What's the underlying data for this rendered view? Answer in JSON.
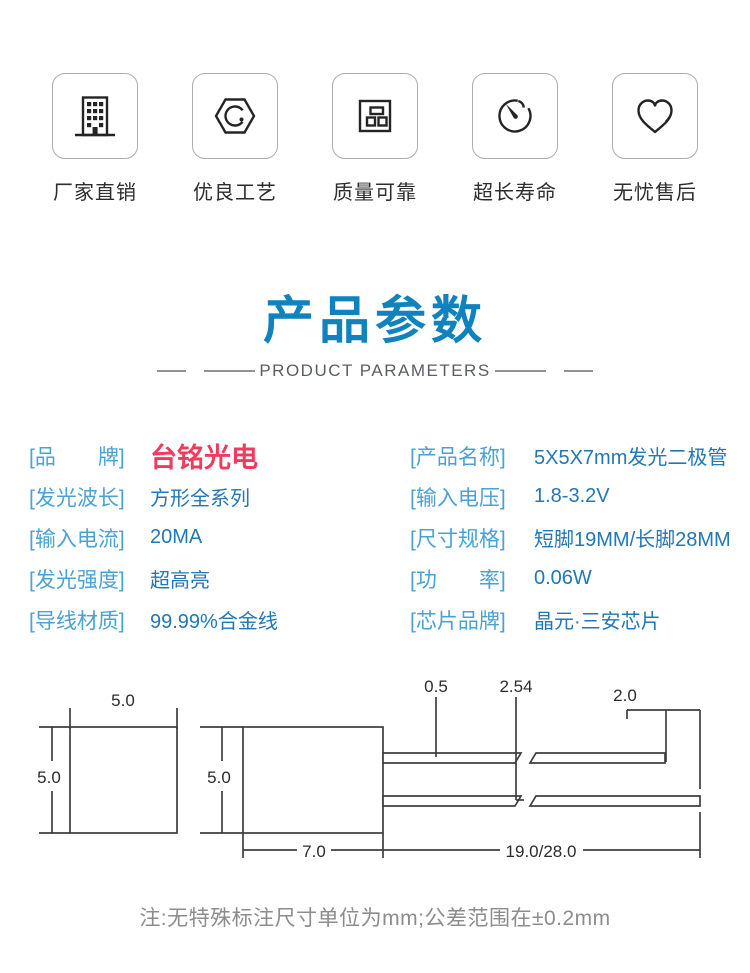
{
  "features": [
    {
      "label": "厂家直销",
      "icon": "building-icon"
    },
    {
      "label": "优良工艺",
      "icon": "craft-gear-hexagon-icon"
    },
    {
      "label": "质量可靠",
      "icon": "quality-blocks-icon"
    },
    {
      "label": "超长寿命",
      "icon": "stopwatch-icon"
    },
    {
      "label": "无忧售后",
      "icon": "heart-icon"
    }
  ],
  "title": {
    "heading": "产品参数",
    "subheading": "PRODUCT PARAMETERS"
  },
  "specs": {
    "left": [
      {
        "label": "[品　　牌]",
        "value": "台铭光电"
      },
      {
        "label": "[发光波长]",
        "value": "方形全系列"
      },
      {
        "label": "[输入电流]",
        "value": "20MA"
      },
      {
        "label": "[发光强度]",
        "value": "超高亮"
      },
      {
        "label": "[导线材质]",
        "value": "99.99%合金线"
      }
    ],
    "right": [
      {
        "label": "[产品名称]",
        "value": "5X5X7mm发光二极管"
      },
      {
        "label": "[输入电压]",
        "value": "1.8-3.2V"
      },
      {
        "label": "[尺寸规格]",
        "value": "短脚19MM/长脚28MM"
      },
      {
        "label": "[功　　率]",
        "value": "0.06W"
      },
      {
        "label": "[芯片品牌]",
        "value": "晶元·三安芯片"
      }
    ]
  },
  "drawing": {
    "units": "mm",
    "dims": {
      "front_width": "5.0",
      "front_height": "5.0",
      "side_height": "5.0",
      "body_length": "7.0",
      "lead_thickness": "0.5",
      "lead_pitch": "2.54",
      "lead_end_offset": "2.0",
      "lead_length": "19.0/28.0"
    }
  },
  "note": "注:无特殊标注尺寸单位为mm;公差范围在±0.2mm",
  "colors": {
    "title_blue": "#1083bf",
    "label_blue": "#4aa2d4",
    "value_blue": "#2277b5",
    "brand_red": "#f23b5c"
  }
}
